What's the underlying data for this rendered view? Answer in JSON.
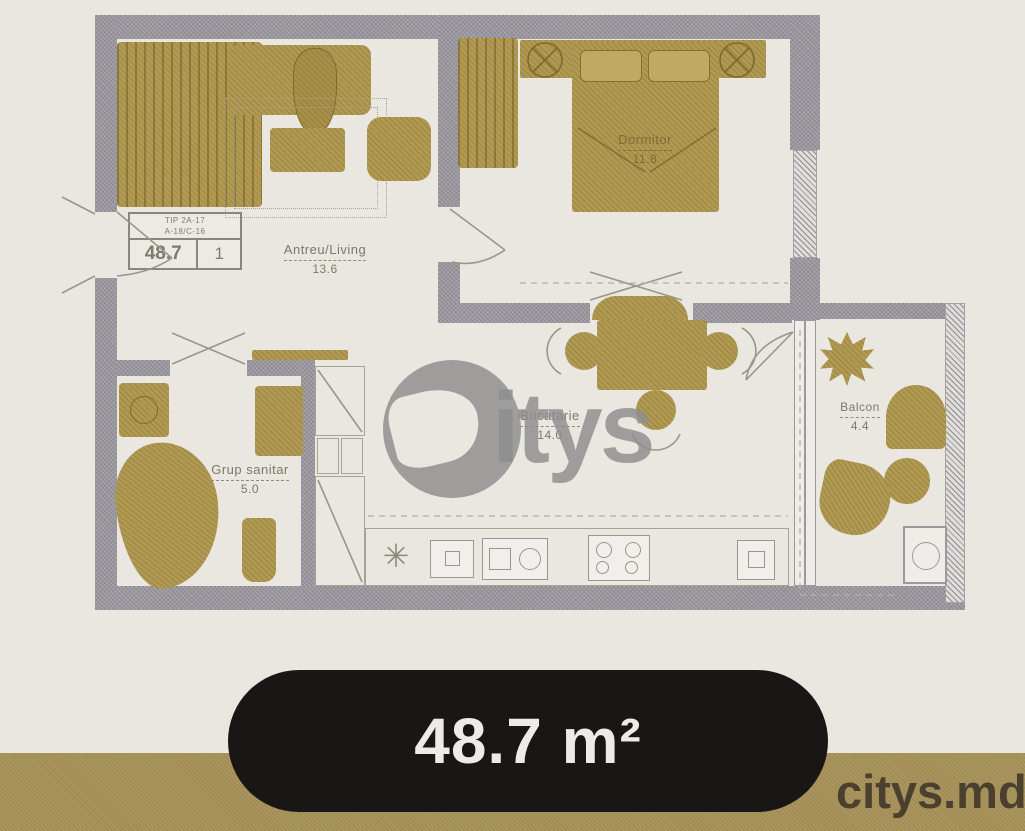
{
  "info_box": {
    "line1": "TIP 2A-17",
    "line2": "A-18/C-16",
    "area_value": "48.7",
    "unit_count": "1"
  },
  "rooms": {
    "living": {
      "name": "Antreu/Living",
      "area": "13.6"
    },
    "bedroom": {
      "name": "Dormitor",
      "area": "11.8"
    },
    "bathroom": {
      "name": "Grup sanitar",
      "area": "5.0"
    },
    "kitchen": {
      "name": "Bucatarie",
      "area": "14.0"
    },
    "balcony": {
      "name": "Balcon",
      "area": "4.4"
    }
  },
  "watermark": {
    "brand": "Citys",
    "logo_text": "itys"
  },
  "badge": {
    "area": "48.7 m²"
  },
  "footer": {
    "site": "citys.md"
  },
  "colors": {
    "furniture": "#b09a53",
    "wall": "#98969c",
    "background": "#eae7e1",
    "bottom_band": "#a28d54",
    "badge_bg": "#191715"
  }
}
